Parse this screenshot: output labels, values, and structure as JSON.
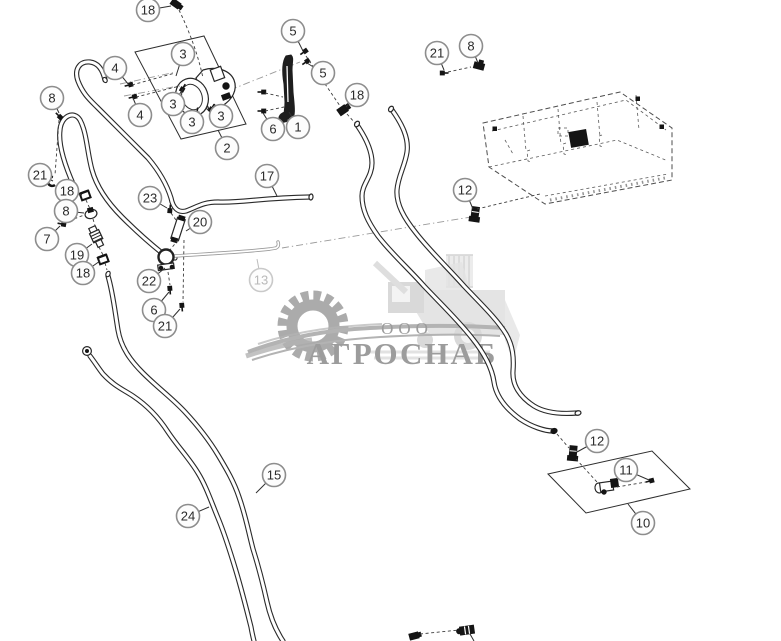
{
  "watermark": {
    "prefix": "ООО",
    "name": "АГРОСНАБ"
  },
  "colors": {
    "line": "#2a2a2a",
    "tube_gray": "#9a9a9a",
    "balloon_ring": "#8d8d8d",
    "muted_balloon": "#c9c9c9",
    "watermark_gray": "#ababab",
    "watermark_text": "#9c9c9c",
    "background": "#ffffff"
  },
  "callouts": [
    {
      "n": "18",
      "x": 148,
      "y": 10,
      "tx": 171,
      "ty": 6
    },
    {
      "n": "4",
      "x": 115,
      "y": 68,
      "tx": 129,
      "ty": 85
    },
    {
      "n": "4",
      "x": 140,
      "y": 115,
      "tx": 133,
      "ty": 98
    },
    {
      "n": "3",
      "x": 183,
      "y": 54,
      "tx": 176,
      "ty": 76
    },
    {
      "n": "3",
      "x": 173,
      "y": 104,
      "tx": 183,
      "ty": 89
    },
    {
      "n": "3",
      "x": 192,
      "y": 122,
      "tx": 197,
      "ty": 112
    },
    {
      "n": "3",
      "x": 221,
      "y": 116,
      "tx": 212,
      "ty": 108
    },
    {
      "n": "2",
      "x": 227,
      "y": 148,
      "tx": 218,
      "ty": 130
    },
    {
      "n": "5",
      "x": 293,
      "y": 31,
      "tx": 303,
      "ty": 51
    },
    {
      "n": "5",
      "x": 323,
      "y": 73,
      "tx": 307,
      "ty": 63
    },
    {
      "n": "6",
      "x": 273,
      "y": 129,
      "tx": 263,
      "ty": 113
    },
    {
      "n": "1",
      "x": 298,
      "y": 127,
      "tx": 289,
      "ty": 112
    },
    {
      "n": "18",
      "x": 357,
      "y": 95,
      "tx": 346,
      "ty": 107
    },
    {
      "n": "21",
      "x": 437,
      "y": 53,
      "tx": 444,
      "ty": 70
    },
    {
      "n": "8",
      "x": 471,
      "y": 46,
      "tx": 478,
      "ty": 63
    },
    {
      "n": "12",
      "x": 465,
      "y": 190,
      "tx": 473,
      "ty": 209
    },
    {
      "n": "8",
      "x": 52,
      "y": 98,
      "tx": 59,
      "ty": 113
    },
    {
      "n": "21",
      "x": 40,
      "y": 175,
      "tx": 53,
      "ty": 181
    },
    {
      "n": "18",
      "x": 67,
      "y": 191,
      "tx": 82,
      "ty": 195
    },
    {
      "n": "8",
      "x": 66,
      "y": 211,
      "tx": 84,
      "ty": 213
    },
    {
      "n": "7",
      "x": 47,
      "y": 239,
      "tx": 60,
      "ty": 226
    },
    {
      "n": "19",
      "x": 77,
      "y": 255,
      "tx": 92,
      "ty": 244
    },
    {
      "n": "18",
      "x": 83,
      "y": 273,
      "tx": 100,
      "ty": 261
    },
    {
      "n": "23",
      "x": 150,
      "y": 198,
      "tx": 167,
      "ty": 208
    },
    {
      "n": "20",
      "x": 200,
      "y": 222,
      "tx": 186,
      "ty": 231
    },
    {
      "n": "22",
      "x": 149,
      "y": 281,
      "tx": 165,
      "ty": 268
    },
    {
      "n": "6",
      "x": 154,
      "y": 310,
      "tx": 169,
      "ty": 292
    },
    {
      "n": "21",
      "x": 165,
      "y": 326,
      "tx": 180,
      "ty": 309
    },
    {
      "n": "17",
      "x": 267,
      "y": 176,
      "tx": 277,
      "ty": 196
    },
    {
      "n": "13",
      "x": 261,
      "y": 280,
      "tx": 257,
      "ty": 259,
      "muted": true
    },
    {
      "n": "24",
      "x": 188,
      "y": 516,
      "tx": 209,
      "ty": 507
    },
    {
      "n": "15",
      "x": 274,
      "y": 475,
      "tx": 256,
      "ty": 493
    },
    {
      "n": "12",
      "x": 597,
      "y": 441,
      "tx": 577,
      "ty": 452
    },
    {
      "n": "11",
      "x": 626,
      "y": 470,
      "tx": 649,
      "ty": 480
    },
    {
      "n": "10",
      "x": 643,
      "y": 523,
      "tx": 628,
      "ty": 504
    }
  ]
}
